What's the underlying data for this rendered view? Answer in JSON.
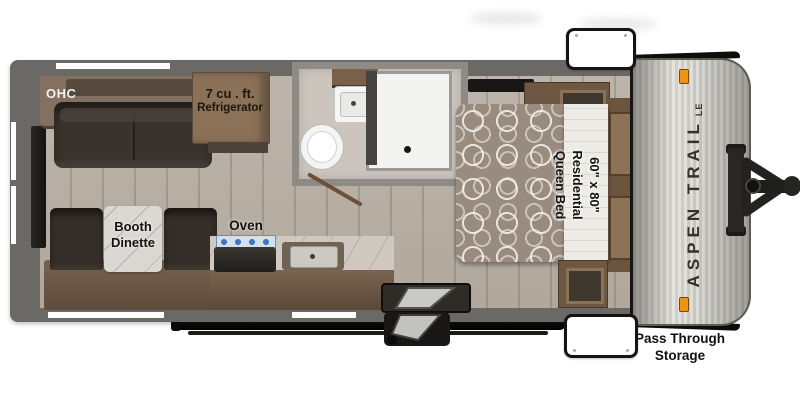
{
  "title": "Aspen Trail LE travel trailer floor plan",
  "brand": {
    "name": "ASPEN TRAIL",
    "badge": "LE"
  },
  "labels": {
    "ohc": "OHC",
    "fridge1": "7 cu . ft.",
    "fridge2": "Refrigerator",
    "booth1": "Booth",
    "booth2": "Dinette",
    "oven": "Oven",
    "bed1": "60\" x 80\"",
    "bed2": "Residential",
    "bed3": "Queen Bed",
    "pass1": "Pass Through",
    "pass2": "Storage"
  },
  "fixtures": [
    "overhead-cabinet",
    "sofa",
    "refrigerator",
    "bathroom-sink",
    "medicine-cabinet",
    "toilet",
    "shower",
    "bathroom-door",
    "booth-dinette",
    "stove-oven",
    "kitchen-sink",
    "entry-steps",
    "queen-bed",
    "wardrobes",
    "nightstand-headboard",
    "rear-tv",
    "awning",
    "front-cap",
    "a-frame-hitch",
    "pass-through-storage-doors",
    "clearance-lights"
  ],
  "colors": {
    "wall": "#6b6965",
    "floor": "#b7afa5",
    "cabinet_wood": "#7d6a57",
    "upholstery": "#3a332d",
    "bedspread": "#998b7e",
    "cap_silver": "#c9c7c1",
    "marker_light": "#ef9410",
    "burner_blue": "#3c78c0",
    "label_text": "#14110e"
  }
}
